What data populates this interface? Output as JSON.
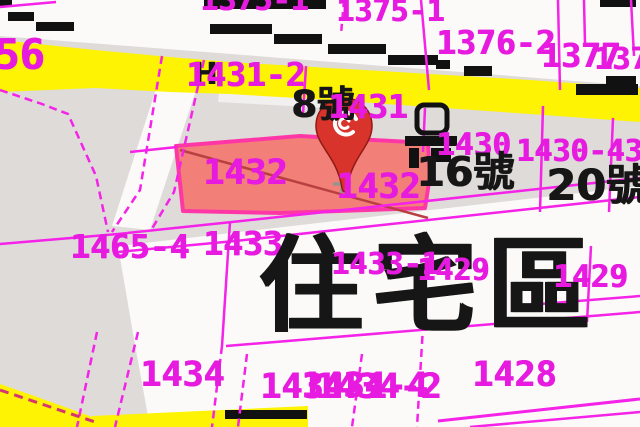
{
  "map": {
    "kind": "cadastral-parcel-map",
    "zone_label": "住宅區",
    "highlighted_parcel": "1432",
    "marker": {
      "name": "location-pin",
      "description": "red teardrop pin with white swirl logo over parcel 1432"
    },
    "colors": {
      "background_gray": "#dedbd9",
      "road_white": "#fbfaf8",
      "road_yellow": "#fdf303",
      "parcel_line_magenta": "#f522e8",
      "label_magenta": "#e71ae0",
      "label_black": "#161616",
      "highlight_fill": "#f28079",
      "highlight_border": "#ff37a6",
      "pin_red": "#d9342b"
    },
    "labels": [
      {
        "text": "1375-1",
        "x": 200,
        "y": -14,
        "size": 30,
        "color": "m"
      },
      {
        "text": "1375-1",
        "x": 336,
        "y": -3,
        "size": 30,
        "color": "m"
      },
      {
        "text": "56",
        "x": -6,
        "y": 34,
        "size": 42,
        "color": "m"
      },
      {
        "text": "1376-2",
        "x": 436,
        "y": 26,
        "size": 33,
        "color": "m"
      },
      {
        "text": "1377",
        "x": 541,
        "y": 39,
        "size": 33,
        "color": "m"
      },
      {
        "text": "1377-2",
        "x": 594,
        "y": 45,
        "size": 30,
        "color": "m"
      },
      {
        "text": "H",
        "x": 192,
        "y": 60,
        "size": 30,
        "color": "k"
      },
      {
        "text": "1431-2",
        "x": 186,
        "y": 58,
        "size": 33,
        "color": "m"
      },
      {
        "text": "8號",
        "x": 291,
        "y": 86,
        "size": 37,
        "color": "k"
      },
      {
        "text": "1431",
        "x": 328,
        "y": 90,
        "size": 33,
        "color": "m"
      },
      {
        "text": "1430",
        "x": 436,
        "y": 130,
        "size": 31,
        "color": "m"
      },
      {
        "text": "1430-43",
        "x": 516,
        "y": 137,
        "size": 30,
        "color": "m"
      },
      {
        "text": "16號",
        "x": 416,
        "y": 152,
        "size": 41,
        "color": "k"
      },
      {
        "text": "20號",
        "x": 546,
        "y": 165,
        "size": 43,
        "color": "k"
      },
      {
        "text": "1432",
        "x": 203,
        "y": 156,
        "size": 35,
        "color": "m"
      },
      {
        "text": "1432",
        "x": 336,
        "y": 170,
        "size": 35,
        "color": "m"
      },
      {
        "text": "1465-4",
        "x": 70,
        "y": 230,
        "size": 33,
        "color": "m"
      },
      {
        "text": "1433",
        "x": 203,
        "y": 227,
        "size": 33,
        "color": "m"
      },
      {
        "text": "住宅區",
        "x": 258,
        "y": 234,
        "size": 104,
        "color": "k",
        "zone": true
      },
      {
        "text": "1433-1",
        "x": 331,
        "y": 250,
        "size": 30,
        "color": "m"
      },
      {
        "text": "1429",
        "x": 417,
        "y": 256,
        "size": 30,
        "color": "m"
      },
      {
        "text": "1429",
        "x": 553,
        "y": 262,
        "size": 31,
        "color": "m"
      },
      {
        "text": "1434",
        "x": 140,
        "y": 358,
        "size": 35,
        "color": "m"
      },
      {
        "text": "1434-1",
        "x": 260,
        "y": 370,
        "size": 35,
        "color": "m"
      },
      {
        "text": "1434-4",
        "x": 301,
        "y": 369,
        "size": 35,
        "color": "m"
      },
      {
        "text": "1434-2",
        "x": 315,
        "y": 370,
        "size": 35,
        "color": "m"
      },
      {
        "text": "1428",
        "x": 472,
        "y": 358,
        "size": 35,
        "color": "m"
      }
    ]
  }
}
